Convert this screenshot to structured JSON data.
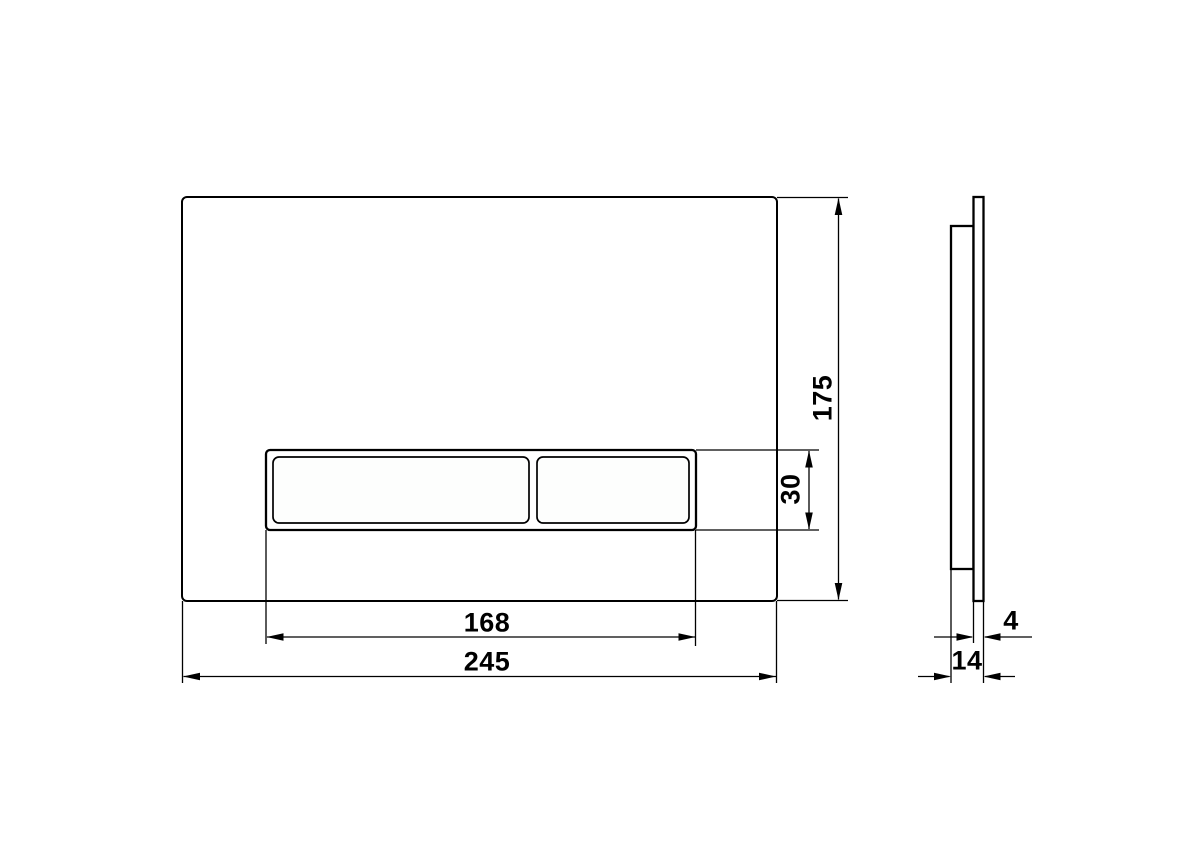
{
  "colors": {
    "background": "#ffffff",
    "line": "#000000",
    "button_fill": "#fdfefd"
  },
  "dimensions": {
    "plate_width_mm": "245",
    "plate_height_mm": "175",
    "recess_width_mm": "168",
    "recess_height_mm": "30",
    "panel_thickness_mm": "4",
    "total_depth_mm": "14"
  }
}
